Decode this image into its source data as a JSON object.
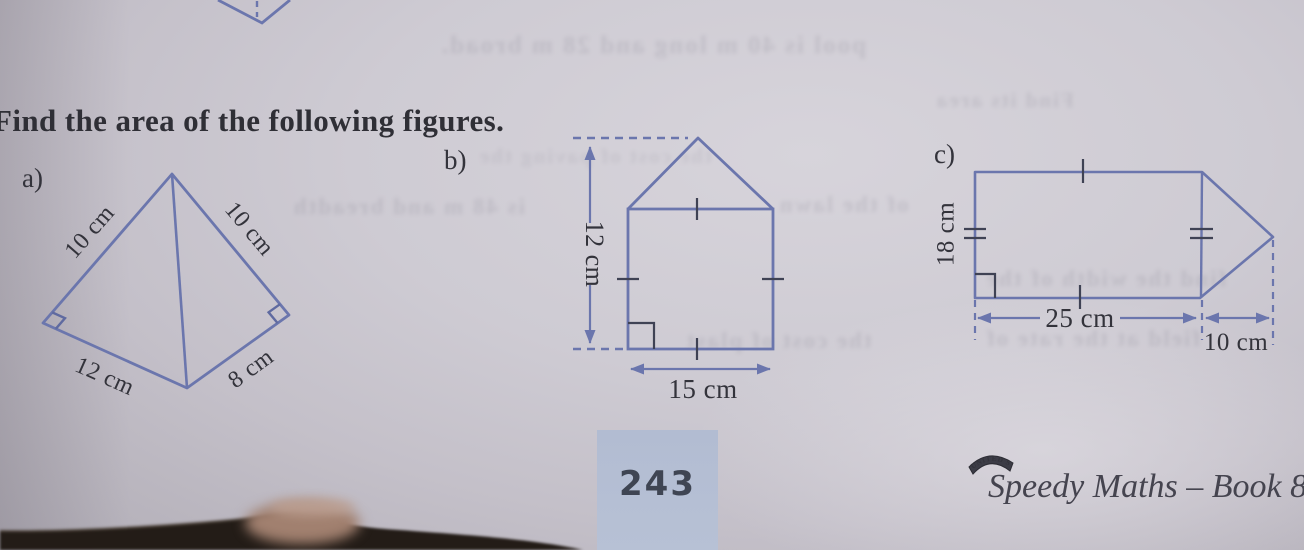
{
  "page": {
    "title": "Find the area of the following figures.",
    "page_number": "243",
    "book_title": "Speedy Maths – Book 8",
    "publisher_badge": "UNITED'S"
  },
  "figures": {
    "a": {
      "label": "a)",
      "side_top_left": "10 cm",
      "side_top_right": "10 cm",
      "side_bottom_left": "12 cm",
      "side_bottom_right": "8 cm"
    },
    "b": {
      "label": "b)",
      "height_label": "12 cm",
      "base_label": "15 cm"
    },
    "c": {
      "label": "c)",
      "height_label": "18 cm",
      "base_label": "25 cm",
      "triangle_label": "10 cm"
    }
  },
  "ghost_texts": [
    {
      "text": "pool is 40 m long and 28 m broad."
    },
    {
      "text": "Find its area"
    },
    {
      "text": "the cost of paving the"
    },
    {
      "text": "is 48 m and breadth"
    },
    {
      "text": "of the lawn"
    },
    {
      "text": "find the width of the"
    },
    {
      "text": "the cost of plast"
    },
    {
      "text": "field at the rate of"
    }
  ],
  "colors": {
    "figure_line": "#6b76ad",
    "mark_dark": "#3f4254",
    "label_text": "#33333b",
    "page_number_box": "#b5bfd4",
    "paper": "#cac7cf",
    "photo_edge": "#231c17"
  }
}
